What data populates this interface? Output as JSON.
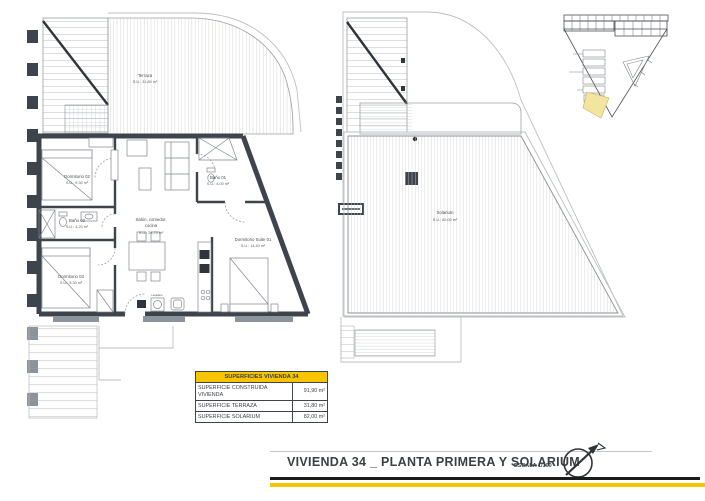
{
  "sheet": {
    "title": "VIVIENDA 34 _ PLANTA PRIMERA Y SOLARIUM",
    "scale": "ESCALA 1/100"
  },
  "plan_first_floor": {
    "terraza": {
      "name": "Terraza",
      "area": "S.U.: 31,80 m²"
    },
    "dormitorio2": {
      "name": "Dormitorio 02",
      "area": "S.U.: 9,30 m²"
    },
    "bano2": {
      "name": "Baño 02",
      "area": "S.U.: 4,20 m²"
    },
    "dormitorio3": {
      "name": "Dormitorio 03",
      "area": "S.U.: 9,30 m²"
    },
    "salon": {
      "line1": "Salón, comedor,",
      "line2": "cocina",
      "area": "S.U.: 28,70 m²"
    },
    "bano1": {
      "name": "Baño 01",
      "area": "S.U.: 4,00 m²"
    },
    "suite": {
      "name": "Dormitorio Suite 01",
      "area": "S.U.: 14,40 m²"
    },
    "lavadero": {
      "name": "Lavadero"
    }
  },
  "plan_solarium": {
    "solarium": {
      "name": "Solarium",
      "area": "S.U.: 82,00 m²"
    }
  },
  "areas_table": {
    "header": "SUPERFICIES VIVIENDA 34",
    "rows": [
      {
        "label": "SUPERFICIE CONSTRUIDA VIVIENDA",
        "value": "91,90 m²"
      },
      {
        "label": "SUPERFICIE TERRAZA",
        "value": "31,80 m²"
      },
      {
        "label": "SUPERFICIE SOLARIUM",
        "value": "82,00 m²"
      }
    ]
  },
  "colors": {
    "accent_yellow": "#f6c500",
    "wall": "#3e444c",
    "hatch": "#cfcfc9",
    "key_highlight": "#f3e4a0"
  }
}
